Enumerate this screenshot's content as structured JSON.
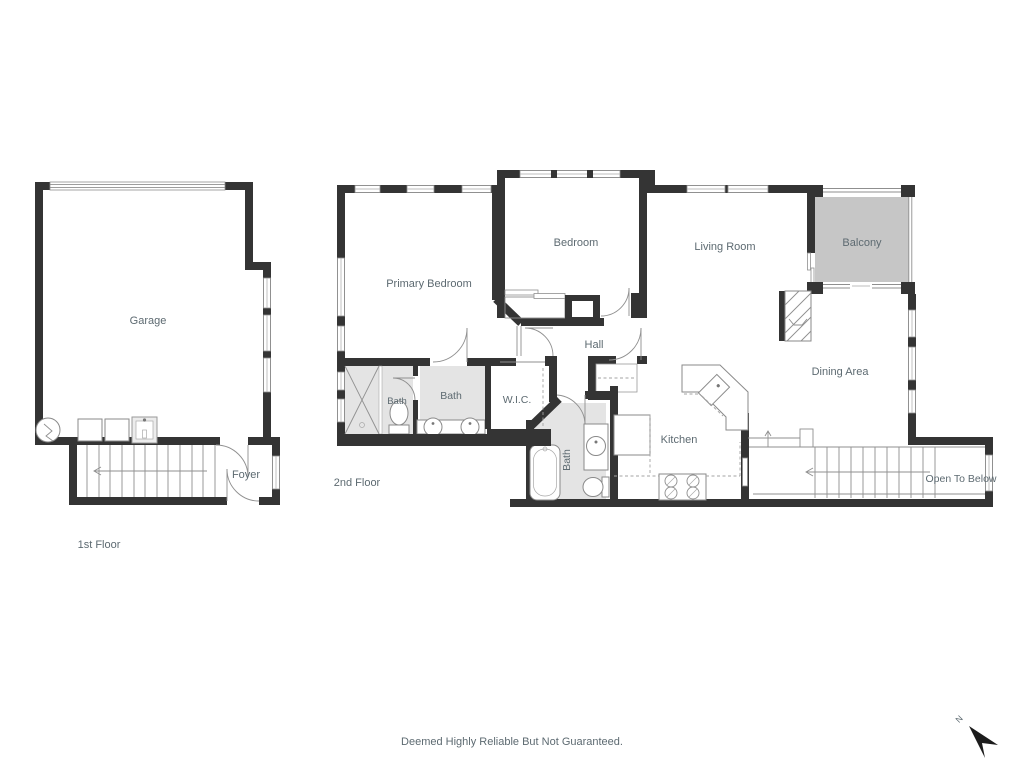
{
  "floor1": {
    "label": "1st Floor",
    "rooms": {
      "garage": "Garage",
      "foyer": "Foyer"
    }
  },
  "floor2": {
    "label": "2nd Floor",
    "rooms": {
      "primary_bedroom": "Primary Bedroom",
      "bedroom": "Bedroom",
      "living_room": "Living Room",
      "balcony": "Balcony",
      "hall": "Hall",
      "dining_area": "Dining Area",
      "kitchen": "Kitchen",
      "wic": "W.I.C.",
      "bath_toilet_room": "Bath",
      "bath_double_vanity": "Bath",
      "bath_hall": "Bath",
      "open_to_below": "Open To Below"
    }
  },
  "footer": {
    "disclaimer": "Deemed Highly Reliable But Not Guaranteed."
  },
  "compass": {
    "north_label": "N"
  },
  "colors": {
    "wall": "#343434",
    "balcony_fill": "#c6c6c6",
    "fixture_fill": "#e4e4e4",
    "thin_line": "#8f8f8f",
    "label_text": "#5d6a71",
    "background": "#ffffff"
  }
}
